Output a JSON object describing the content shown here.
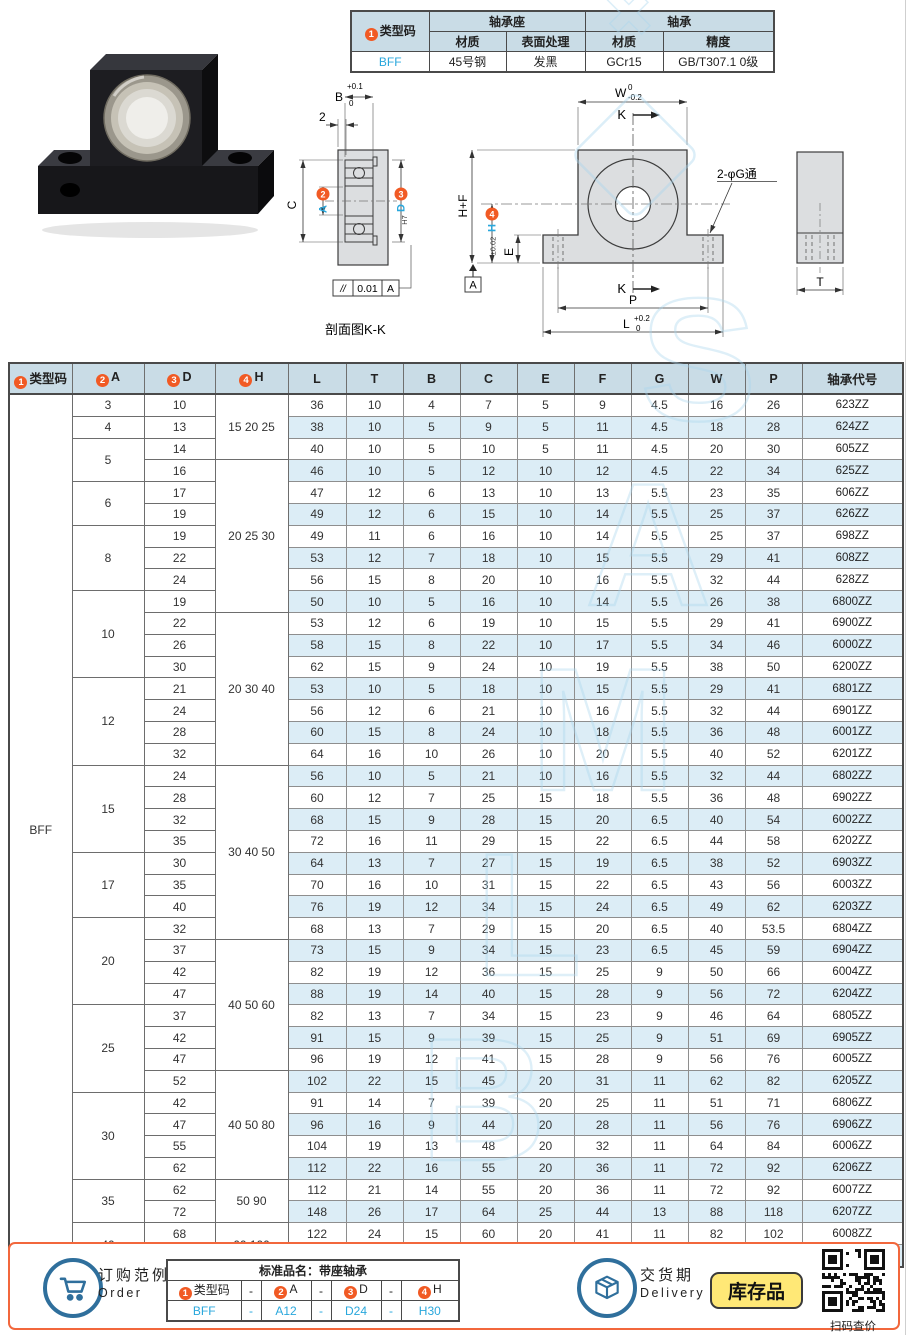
{
  "page": {
    "watermark": "SAMLB"
  },
  "spec_table": {
    "badge": "1",
    "type_code_header": "类型码",
    "group_housing": "轴承座",
    "group_bearing": "轴承",
    "sub_headers": [
      "材质",
      "表面处理",
      "材质",
      "精度"
    ],
    "type_code": "BFF",
    "values": [
      "45号钢",
      "发黑",
      "GCr15",
      "GB/T307.1 0级"
    ]
  },
  "drawing": {
    "section": {
      "b": "B",
      "b_up": "+0.1",
      "b_dn": "0",
      "two": "2",
      "c": "C",
      "a": "A",
      "d": "D",
      "d_fit": "H7",
      "flat_sym": "//",
      "flat_val": "0.01",
      "flat_ref": "A",
      "caption": "剖面图K-K"
    },
    "front": {
      "w": "W",
      "w_up": "0",
      "w_dn": "-0.2",
      "k": "K",
      "hf": "H+F",
      "h": "H",
      "h_tol": "±0.02",
      "e": "E",
      "datum": "A",
      "p": "P",
      "l": "L",
      "l_up": "+0.2",
      "l_dn": "0",
      "holes": "2-φG通"
    },
    "side": {
      "t": "T"
    },
    "badges": {
      "b2": "2",
      "b3": "3",
      "b4": "4"
    }
  },
  "main_table": {
    "headers": [
      "类型码",
      "A",
      "D",
      "H",
      "L",
      "T",
      "B",
      "C",
      "E",
      "F",
      "G",
      "W",
      "P",
      "轴承代号"
    ],
    "badges": [
      "1",
      "2",
      "3",
      "4"
    ],
    "type_code": "BFF",
    "a_groups": [
      [
        "3",
        1
      ],
      [
        "4",
        1
      ],
      [
        "5",
        2
      ],
      [
        "6",
        2
      ],
      [
        "8",
        3
      ],
      [
        "10",
        4
      ],
      [
        "12",
        4
      ],
      [
        "15",
        4
      ],
      [
        "17",
        3
      ],
      [
        "20",
        4
      ],
      [
        "25",
        4
      ],
      [
        "30",
        4
      ],
      [
        "35",
        2
      ],
      [
        "40",
        2
      ]
    ],
    "h_groups": [
      [
        "15 20 25",
        3
      ],
      [
        "20 25 30",
        7
      ],
      [
        "20 30 40",
        7
      ],
      [
        "30 40 50",
        8
      ],
      [
        "40 50 60",
        6
      ],
      [
        "40 50 80",
        5
      ],
      [
        "50 90",
        2
      ],
      [
        "60 100",
        2
      ]
    ],
    "rows": [
      [
        "10",
        "36",
        "10",
        "4",
        "7",
        "5",
        "9",
        "4.5",
        "16",
        "26",
        "623ZZ"
      ],
      [
        "13",
        "38",
        "10",
        "5",
        "9",
        "5",
        "11",
        "4.5",
        "18",
        "28",
        "624ZZ"
      ],
      [
        "14",
        "40",
        "10",
        "5",
        "10",
        "5",
        "11",
        "4.5",
        "20",
        "30",
        "605ZZ"
      ],
      [
        "16",
        "46",
        "10",
        "5",
        "12",
        "10",
        "12",
        "4.5",
        "22",
        "34",
        "625ZZ"
      ],
      [
        "17",
        "47",
        "12",
        "6",
        "13",
        "10",
        "13",
        "5.5",
        "23",
        "35",
        "606ZZ"
      ],
      [
        "19",
        "49",
        "12",
        "6",
        "15",
        "10",
        "14",
        "5.5",
        "25",
        "37",
        "626ZZ"
      ],
      [
        "19",
        "49",
        "11",
        "6",
        "16",
        "10",
        "14",
        "5.5",
        "25",
        "37",
        "698ZZ"
      ],
      [
        "22",
        "53",
        "12",
        "7",
        "18",
        "10",
        "15",
        "5.5",
        "29",
        "41",
        "608ZZ"
      ],
      [
        "24",
        "56",
        "15",
        "8",
        "20",
        "10",
        "16",
        "5.5",
        "32",
        "44",
        "628ZZ"
      ],
      [
        "19",
        "50",
        "10",
        "5",
        "16",
        "10",
        "14",
        "5.5",
        "26",
        "38",
        "6800ZZ"
      ],
      [
        "22",
        "53",
        "12",
        "6",
        "19",
        "10",
        "15",
        "5.5",
        "29",
        "41",
        "6900ZZ"
      ],
      [
        "26",
        "58",
        "15",
        "8",
        "22",
        "10",
        "17",
        "5.5",
        "34",
        "46",
        "6000ZZ"
      ],
      [
        "30",
        "62",
        "15",
        "9",
        "24",
        "10",
        "19",
        "5.5",
        "38",
        "50",
        "6200ZZ"
      ],
      [
        "21",
        "53",
        "10",
        "5",
        "18",
        "10",
        "15",
        "5.5",
        "29",
        "41",
        "6801ZZ"
      ],
      [
        "24",
        "56",
        "12",
        "6",
        "21",
        "10",
        "16",
        "5.5",
        "32",
        "44",
        "6901ZZ"
      ],
      [
        "28",
        "60",
        "15",
        "8",
        "24",
        "10",
        "18",
        "5.5",
        "36",
        "48",
        "6001ZZ"
      ],
      [
        "32",
        "64",
        "16",
        "10",
        "26",
        "10",
        "20",
        "5.5",
        "40",
        "52",
        "6201ZZ"
      ],
      [
        "24",
        "56",
        "10",
        "5",
        "21",
        "10",
        "16",
        "5.5",
        "32",
        "44",
        "6802ZZ"
      ],
      [
        "28",
        "60",
        "12",
        "7",
        "25",
        "15",
        "18",
        "5.5",
        "36",
        "48",
        "6902ZZ"
      ],
      [
        "32",
        "68",
        "15",
        "9",
        "28",
        "15",
        "20",
        "6.5",
        "40",
        "54",
        "6002ZZ"
      ],
      [
        "35",
        "72",
        "16",
        "11",
        "29",
        "15",
        "22",
        "6.5",
        "44",
        "58",
        "6202ZZ"
      ],
      [
        "30",
        "64",
        "13",
        "7",
        "27",
        "15",
        "19",
        "6.5",
        "38",
        "52",
        "6903ZZ"
      ],
      [
        "35",
        "70",
        "16",
        "10",
        "31",
        "15",
        "22",
        "6.5",
        "43",
        "56",
        "6003ZZ"
      ],
      [
        "40",
        "76",
        "19",
        "12",
        "34",
        "15",
        "24",
        "6.5",
        "49",
        "62",
        "6203ZZ"
      ],
      [
        "32",
        "68",
        "13",
        "7",
        "29",
        "15",
        "20",
        "6.5",
        "40",
        "53.5",
        "6804ZZ"
      ],
      [
        "37",
        "73",
        "15",
        "9",
        "34",
        "15",
        "23",
        "6.5",
        "45",
        "59",
        "6904ZZ"
      ],
      [
        "42",
        "82",
        "19",
        "12",
        "36",
        "15",
        "25",
        "9",
        "50",
        "66",
        "6004ZZ"
      ],
      [
        "47",
        "88",
        "19",
        "14",
        "40",
        "15",
        "28",
        "9",
        "56",
        "72",
        "6204ZZ"
      ],
      [
        "37",
        "82",
        "13",
        "7",
        "34",
        "15",
        "23",
        "9",
        "46",
        "64",
        "6805ZZ"
      ],
      [
        "42",
        "91",
        "15",
        "9",
        "39",
        "15",
        "25",
        "9",
        "51",
        "69",
        "6905ZZ"
      ],
      [
        "47",
        "96",
        "19",
        "12",
        "41",
        "15",
        "28",
        "9",
        "56",
        "76",
        "6005ZZ"
      ],
      [
        "52",
        "102",
        "22",
        "15",
        "45",
        "20",
        "31",
        "11",
        "62",
        "82",
        "6205ZZ"
      ],
      [
        "42",
        "91",
        "14",
        "7",
        "39",
        "20",
        "25",
        "11",
        "51",
        "71",
        "6806ZZ"
      ],
      [
        "47",
        "96",
        "16",
        "9",
        "44",
        "20",
        "28",
        "11",
        "56",
        "76",
        "6906ZZ"
      ],
      [
        "55",
        "104",
        "19",
        "13",
        "48",
        "20",
        "32",
        "11",
        "64",
        "84",
        "6006ZZ"
      ],
      [
        "62",
        "112",
        "22",
        "16",
        "55",
        "20",
        "36",
        "11",
        "72",
        "92",
        "6206ZZ"
      ],
      [
        "62",
        "112",
        "21",
        "14",
        "55",
        "20",
        "36",
        "11",
        "72",
        "92",
        "6007ZZ"
      ],
      [
        "72",
        "148",
        "26",
        "17",
        "64",
        "25",
        "44",
        "13",
        "88",
        "118",
        "6207ZZ"
      ],
      [
        "68",
        "122",
        "24",
        "15",
        "60",
        "20",
        "41",
        "11",
        "82",
        "102",
        "6008ZZ"
      ],
      [
        "80",
        "160",
        "27",
        "18",
        "74",
        "25",
        "50",
        "13",
        "100",
        "130",
        "6208ZZ"
      ]
    ]
  },
  "footer": {
    "order_label_cn": "订购范例",
    "order_label_en": "Order",
    "order_table_title": "标准品名：带座轴承",
    "dash": "-",
    "badges": [
      "1",
      "2",
      "3",
      "4"
    ],
    "order_headers": [
      "类型码",
      "A",
      "D",
      "H"
    ],
    "order_values": [
      "BFF",
      "A12",
      "D24",
      "H30"
    ],
    "delivery_label_cn": "交货期",
    "delivery_label_en": "Delivery",
    "stock_badge": "库存品",
    "qr_caption": "扫码查价"
  }
}
